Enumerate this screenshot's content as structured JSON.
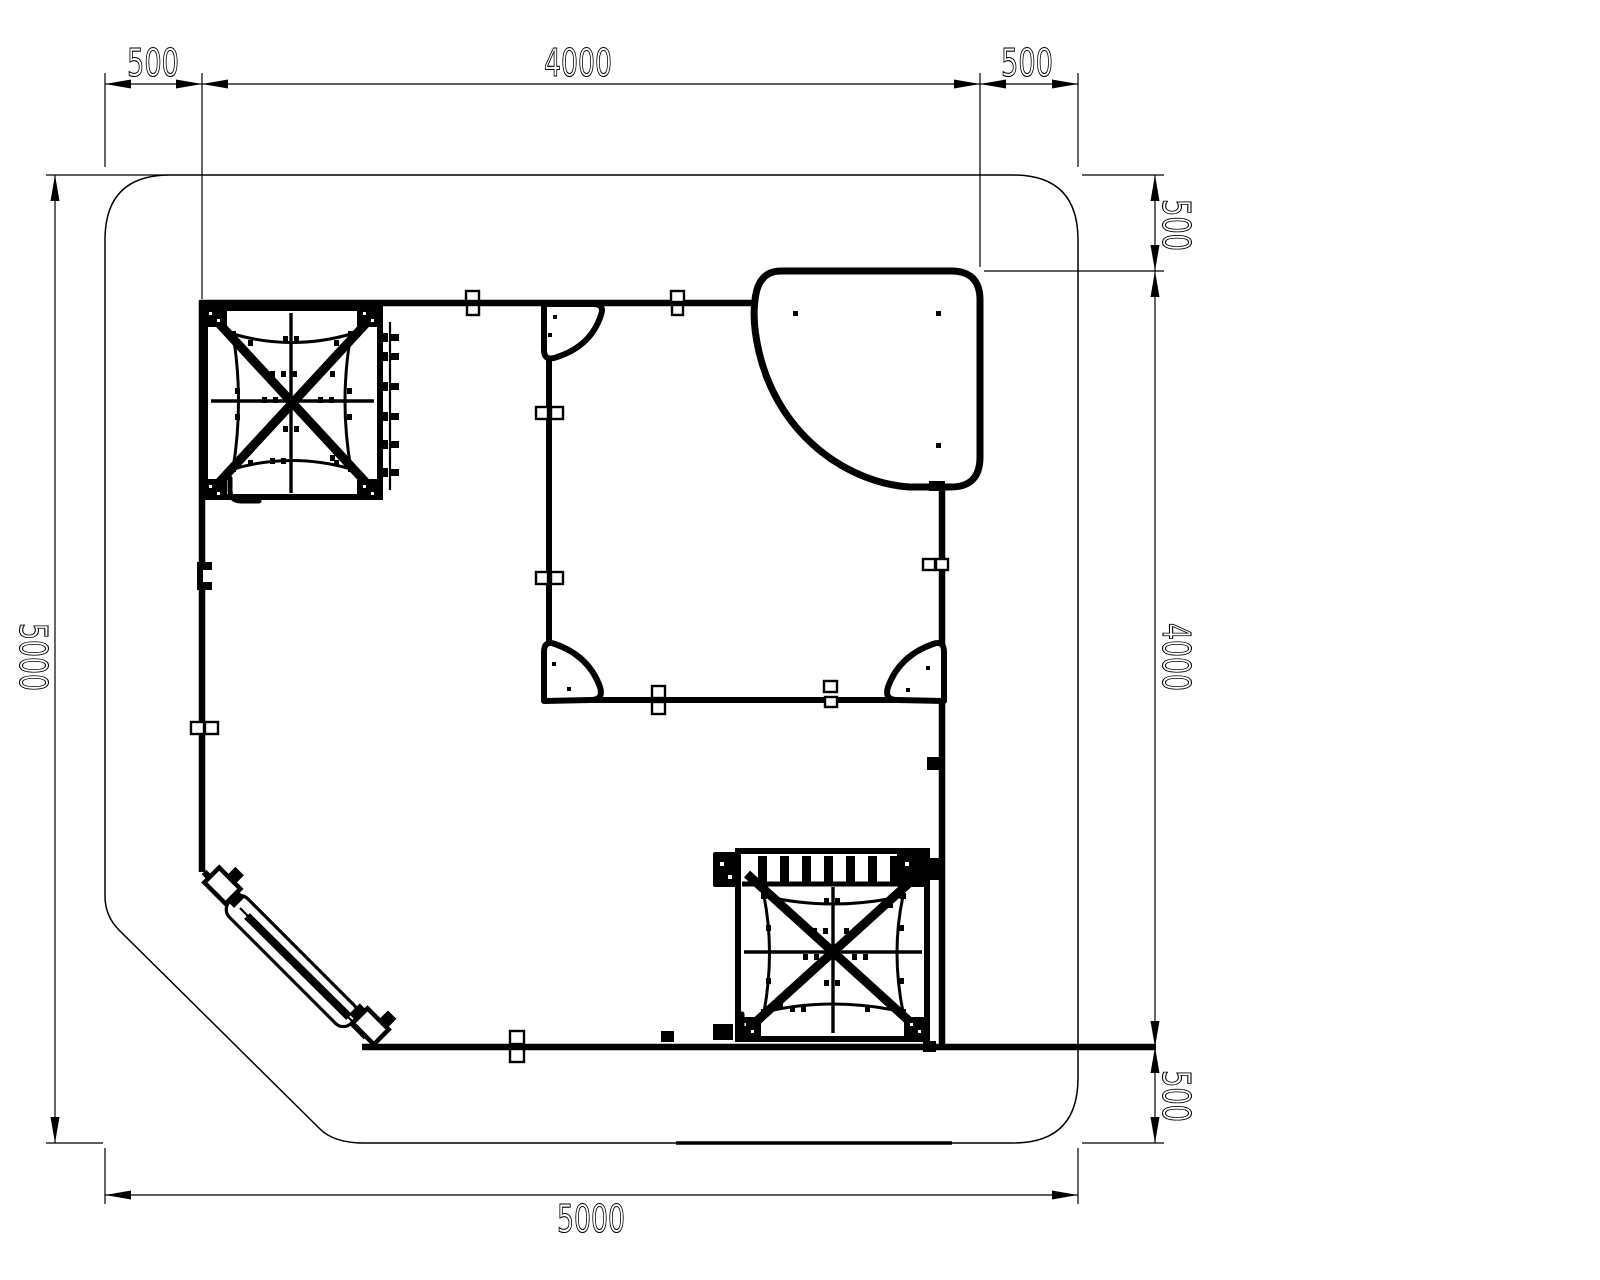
{
  "drawing": {
    "type": "cad-plan-view",
    "subject": "playground-trampoline-park-layout-top-view"
  },
  "colors": {
    "ink": "#000000",
    "paper": "#ffffff"
  },
  "labels": {
    "dim_top_left": "500",
    "dim_top_span": "4000",
    "dim_top_right": "500",
    "dim_right_top": "500",
    "dim_right_span": "4000",
    "dim_right_bottom": "500",
    "dim_left_overall": "5000",
    "dim_bottom_overall": "5000"
  }
}
